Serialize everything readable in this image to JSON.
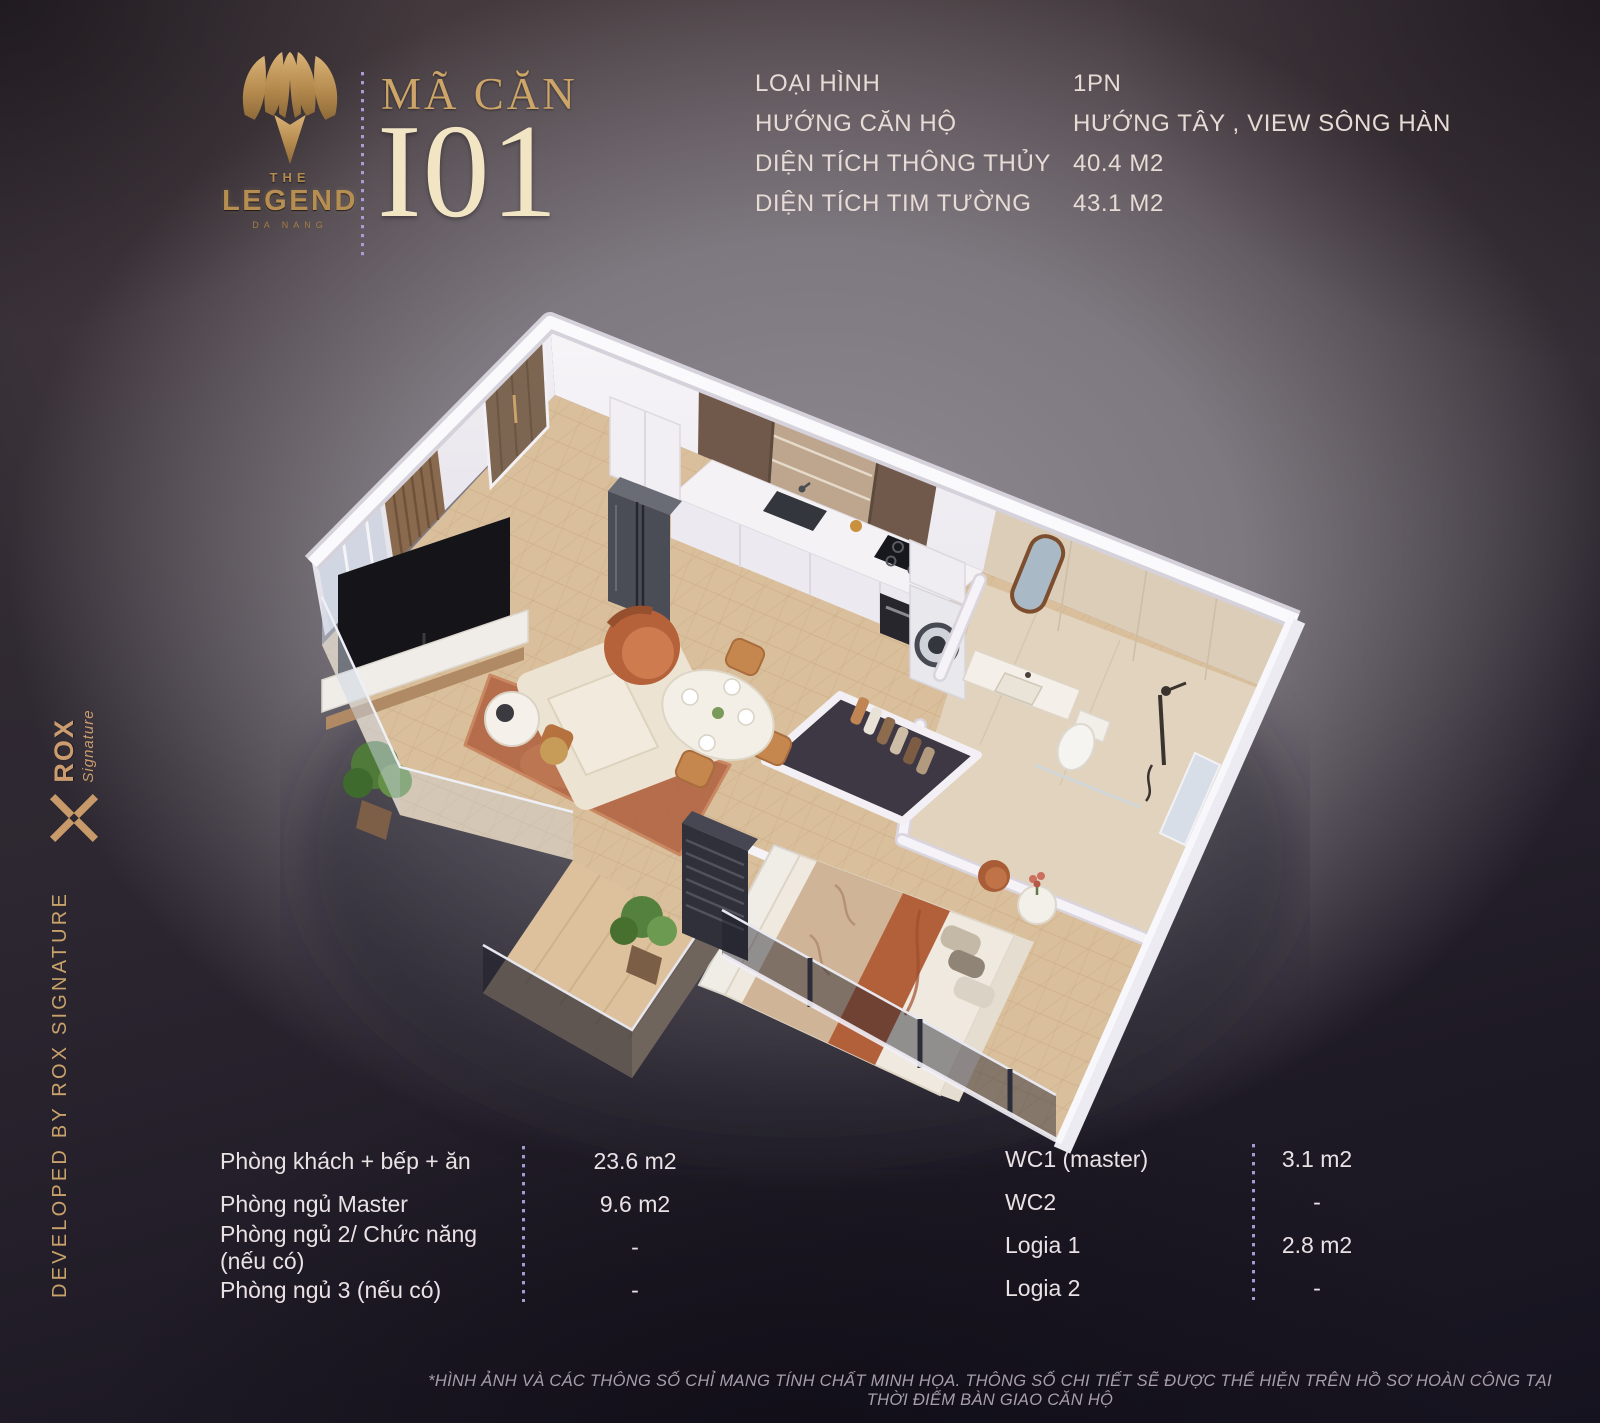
{
  "brand": {
    "the": "THE",
    "name": "LEGEND",
    "city": "DA NANG"
  },
  "unit": {
    "label": "MÃ CĂN",
    "code": "I01"
  },
  "specs": {
    "rows": [
      {
        "label": "LOẠI HÌNH",
        "value": "1PN"
      },
      {
        "label": "HƯỚNG CĂN HỘ",
        "value": "HƯỚNG TÂY , VIEW SÔNG HÀN"
      },
      {
        "label": "DIỆN TÍCH THÔNG THỦY",
        "value": "40.4 M2"
      },
      {
        "label": "DIỆN TÍCH TIM TƯỜNG",
        "value": "43.1 M2"
      }
    ]
  },
  "areas": {
    "left": [
      {
        "label": "Phòng khách + bếp + ăn",
        "value": "23.6 m2"
      },
      {
        "label": "Phòng ngủ Master",
        "value": "9.6 m2"
      },
      {
        "label": "Phòng ngủ 2/ Chức năng (nếu có)",
        "value": "-"
      },
      {
        "label": "Phòng ngủ 3 (nếu có)",
        "value": "-"
      }
    ],
    "right": [
      {
        "label": "WC1 (master)",
        "value": "3.1 m2"
      },
      {
        "label": "WC2",
        "value": "-"
      },
      {
        "label": "Logia 1",
        "value": "2.8 m2"
      },
      {
        "label": "Logia 2",
        "value": "-"
      }
    ]
  },
  "developer": {
    "vertical_text": "DEVELOPED BY ROX SIGNATURE",
    "logo_name": "ROX",
    "logo_sub": "Signature"
  },
  "disclaimer": "*HÌNH ẢNH VÀ CÁC THÔNG SỐ CHỈ MANG TÍNH CHẤT MINH HỌA. THÔNG SỐ CHI TIẾT SẼ ĐƯỢC THỂ HIỆN TRÊN HỒ SƠ HOÀN CÔNG TẠI THỜI ĐIỂM BÀN GIAO CĂN HỘ",
  "colors": {
    "accent_gold": "#c49a5f",
    "title_cream": "#f2e5c4",
    "text_light": "#e7dbd6",
    "divider_dot": "#aca3d7",
    "rug_rust": "#b26745",
    "wall_white": "#f3f1f5",
    "floor_wood": "#d9bf9c"
  }
}
